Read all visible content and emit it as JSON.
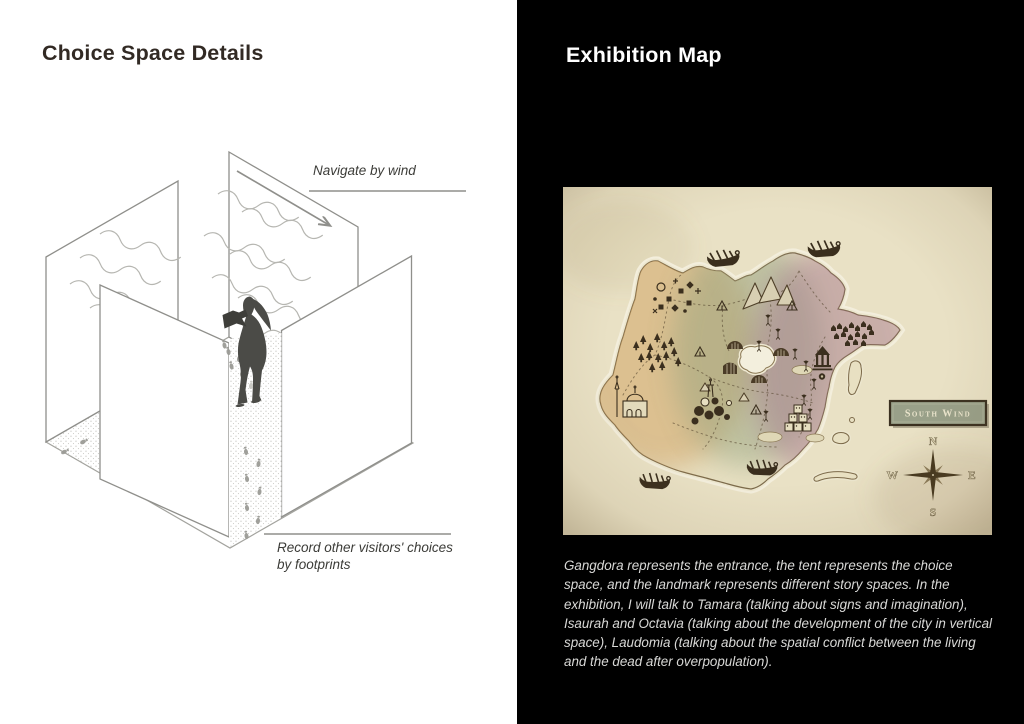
{
  "left_panel": {
    "title": "Choice Space Details",
    "diagram": {
      "wind_label": "Navigate by wind",
      "footprints_label_line1": "Record other visitors' choices",
      "footprints_label_line2": "by footprints"
    }
  },
  "right_panel": {
    "title": "Exhibition Map",
    "map": {
      "banner_label": "South Wind",
      "compass": {
        "north": "N",
        "east": "E",
        "south": "S",
        "west": "W"
      },
      "features": [
        "island",
        "ships",
        "mountains",
        "forest",
        "mosque",
        "lake",
        "tents",
        "temple",
        "city",
        "village",
        "trails",
        "islets",
        "compass-rose",
        "south-wind-banner"
      ]
    },
    "caption": "Gangdora represents the entrance, the tent represents the choice space, and the landmark represents different story spaces. In the exhibition, I will talk to Tamara (talking about signs and imagination), Isaurah and Octavia (talking about the development of the city in vertical space), Laudomia (talking about the spatial conflict between the living and the dead after overpopulation)."
  },
  "colors": {
    "left_bg": "#ffffff",
    "right_bg": "#000000",
    "title_dark": "#322a24",
    "title_light": "#ffffff",
    "caption_text": "#d8d8d6",
    "diagram_line": "#8f8f8b",
    "figure": "#4b4b47",
    "parchment": "#e9e1c5",
    "region_tan": "#cf9f5e",
    "region_green": "#8fa07e",
    "region_mauve": "#a3718b",
    "map_ink": "#3b2f1e",
    "banner_fill": "#99a089"
  }
}
